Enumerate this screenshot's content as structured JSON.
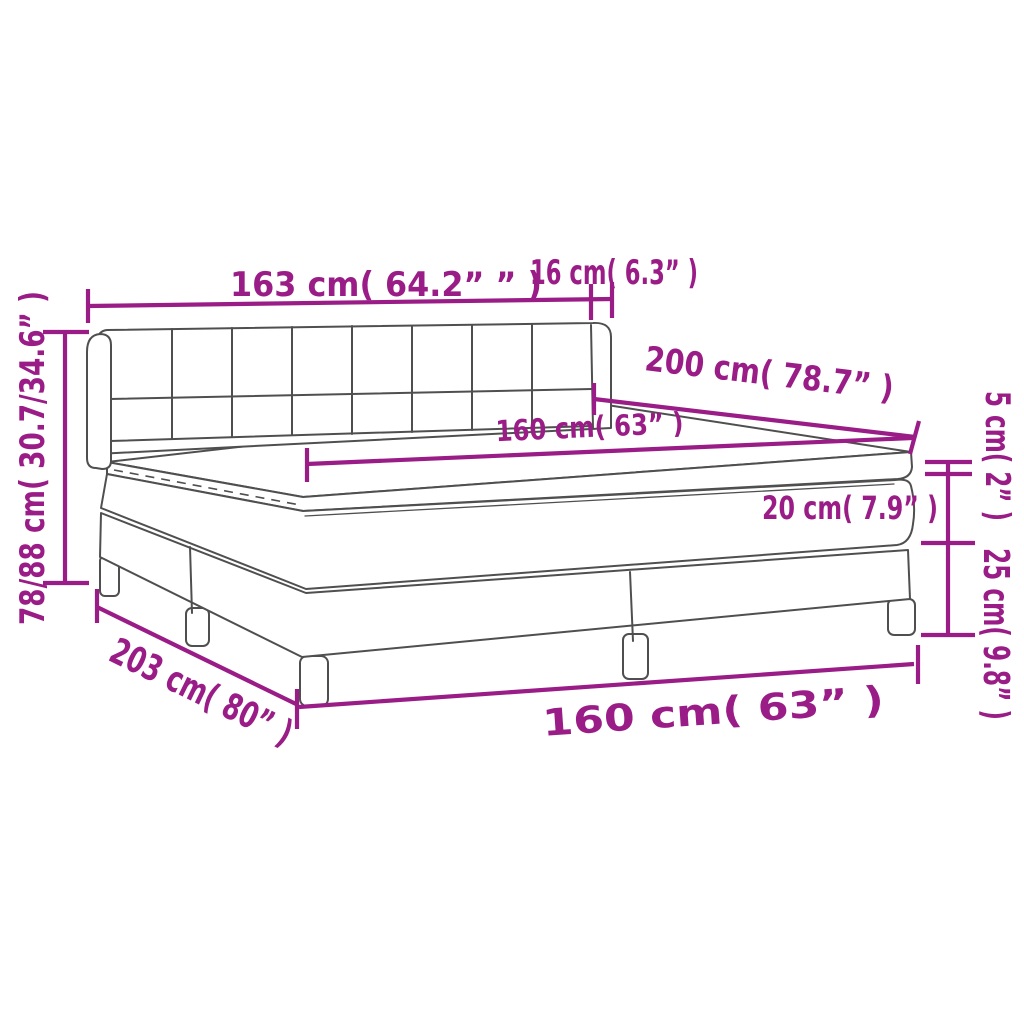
{
  "diagram": {
    "title": "box-spring-bed-dimension-diagram",
    "labels": {
      "headboard_width": "163 cm( 64.2” ” )",
      "headboard_side": "16 cm( 6.3” )",
      "bed_length": "200 cm( 78.7” )",
      "mattress_width": "160 cm( 63” )",
      "topper_height": "5 cm( 2” )",
      "mattress_height": "20 cm( 7.9” )",
      "base_height": "25 cm( 9.8” )",
      "total_height": "78/88 cm( 30.7/34.6” )",
      "base_length": "203 cm( 80” )",
      "base_width": "160 cm( 63” )"
    },
    "colors": {
      "dimension": "#9A1C87",
      "outline": "#4f4f4f",
      "background": "#ffffff"
    }
  }
}
